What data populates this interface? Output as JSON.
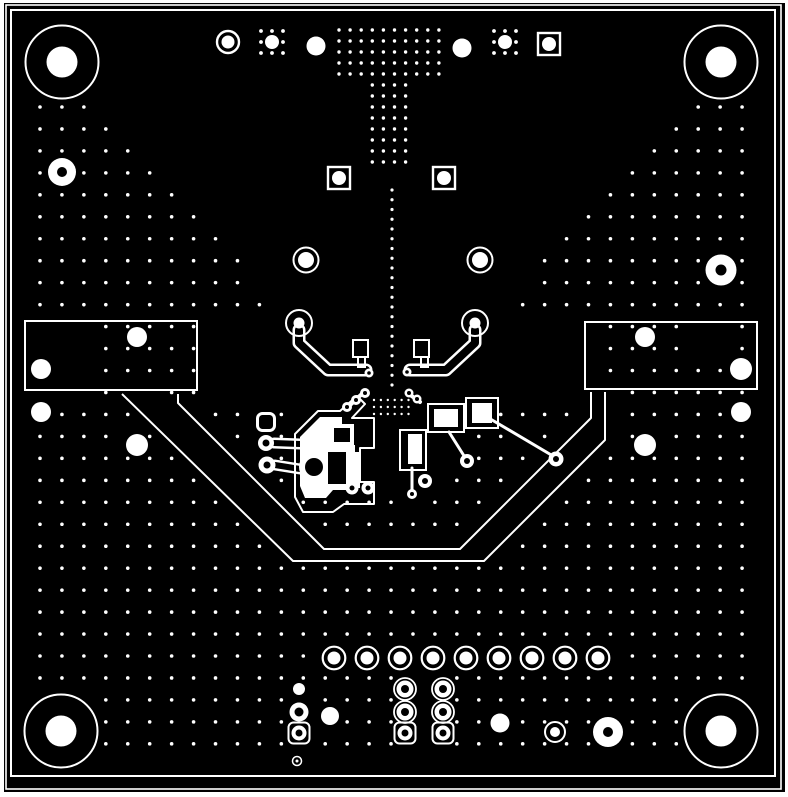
{
  "meta": {
    "title": "PCB copper layer artwork",
    "type": "pcb-gerber-view"
  },
  "canvas": {
    "w": 788,
    "h": 797
  },
  "colors": {
    "page": "#ffffff",
    "board": "#000000",
    "art": "#ffffff"
  },
  "frame": {
    "board_rect": [
      4,
      3,
      781,
      789
    ],
    "outline_rects": [
      {
        "r": [
          6,
          5,
          775,
          784
        ],
        "sw": 1.6
      },
      {
        "r": [
          11,
          10,
          764,
          766
        ],
        "sw": 2
      }
    ]
  },
  "grid": {
    "x0": 40,
    "y0": 107,
    "dx": 21.94,
    "dy": 21.96,
    "nx": 33,
    "ny": 30,
    "r": 1.8
  },
  "grid_exclusions": {
    "rects": [
      [
        0,
        0,
        788,
        97
      ],
      [
        197,
        318,
        392,
        75
      ],
      [
        0,
        318,
        102,
        75
      ],
      [
        688,
        318,
        48,
        52
      ],
      [
        285,
        393,
        165,
        104
      ],
      [
        338,
        385,
        66,
        14
      ],
      [
        464,
        396,
        36,
        34
      ],
      [
        398,
        428,
        30,
        44
      ],
      [
        426,
        402,
        40,
        32
      ]
    ],
    "polys": [
      [
        [
          95,
          97
        ],
        [
          391,
          97
        ],
        [
          391,
          318
        ],
        [
          290,
          318
        ]
      ],
      [
        [
          391,
          97
        ],
        [
          687,
          97
        ],
        [
          492,
          318
        ],
        [
          391,
          318
        ]
      ]
    ],
    "corridors": [
      {
        "pts": [
          [
            122,
            394
          ],
          [
            293,
            561
          ],
          [
            484,
            561
          ],
          [
            605,
            440
          ],
          [
            605,
            392
          ]
        ],
        "r": 6.5
      },
      {
        "pts": [
          [
            178,
            394
          ],
          [
            178,
            403
          ],
          [
            324,
            549
          ],
          [
            460,
            549
          ],
          [
            591,
            418
          ],
          [
            591,
            392
          ]
        ],
        "r": 6.5
      },
      {
        "pts": [
          [
            150,
            396
          ],
          [
            308,
            555
          ],
          [
            472,
            555
          ],
          [
            598,
            428
          ],
          [
            598,
            392
          ]
        ],
        "r": 9
      },
      {
        "pts": [
          [
            487,
            417
          ],
          [
            553,
            456
          ]
        ],
        "r": 7
      },
      {
        "pts": [
          [
            449,
            432
          ],
          [
            466,
            459
          ]
        ],
        "r": 7
      },
      {
        "pts": [
          [
            412,
            468
          ],
          [
            412,
            492
          ]
        ],
        "r": 6
      }
    ]
  },
  "t_field": {
    "wide": {
      "x0": 339,
      "dx": 11.1,
      "cols": 10,
      "y0": 30,
      "dy": 11,
      "rows": 5,
      "r": 1.7
    },
    "stem": {
      "x0": 372.3,
      "dx": 11.1,
      "cols": 4,
      "y0": 85,
      "dy": 11,
      "rows": 8,
      "r": 1.7
    }
  },
  "dotted_line": {
    "x": 392,
    "y0": 190,
    "y1": 385,
    "step": 9.75,
    "r": 1.6
  },
  "fine_grid": {
    "x0": 374,
    "dx": 6.9,
    "cols": 6,
    "y0": 400,
    "dy": 7,
    "rows": 3,
    "r": 1.2
  },
  "satellite_pads": [
    {
      "cx": 272,
      "cy": 42,
      "fill_r": 7,
      "dot_r": 1.9,
      "offset": 11
    },
    {
      "cx": 505,
      "cy": 42,
      "fill_r": 7,
      "dot_r": 1.9,
      "offset": 11
    }
  ],
  "mount_holes": {
    "pts": [
      [
        62,
        62
      ],
      [
        721,
        62
      ],
      [
        61,
        731
      ],
      [
        721,
        731
      ]
    ],
    "ring_r": 36.5,
    "ring_sw": 2,
    "fill_r": 15.5
  },
  "edge_vias": [
    [
      62,
      172,
      14,
      5
    ],
    [
      721,
      270,
      15.5,
      5.5
    ],
    [
      608,
      732,
      15,
      5
    ]
  ],
  "filled_dots": [
    [
      316,
      46,
      9.5
    ],
    [
      462,
      48,
      9.5
    ],
    [
      41,
      369,
      10
    ],
    [
      137,
      337,
      10
    ],
    [
      41,
      412,
      10
    ],
    [
      137,
      445,
      11
    ],
    [
      645,
      337,
      10
    ],
    [
      741,
      369,
      11
    ],
    [
      741,
      412,
      10
    ],
    [
      645,
      445,
      11
    ],
    [
      330,
      716,
      9
    ],
    [
      500,
      723,
      9.5
    ],
    [
      299,
      689,
      6
    ]
  ],
  "ring_pads": [
    [
      228,
      42,
      11,
      2.4,
      6.5
    ],
    [
      306,
      260,
      12.5,
      2,
      8
    ],
    [
      480,
      260,
      12.5,
      2,
      8
    ],
    [
      299,
      323,
      13,
      2,
      5.5
    ],
    [
      475,
      323,
      13,
      2,
      5.5
    ],
    [
      555,
      732,
      10,
      2,
      5
    ]
  ],
  "header_row": {
    "y": 658,
    "x0": 334,
    "dx": 33,
    "n": 9,
    "ring_r": 11.3,
    "ring_sw": 2.2,
    "fill_r": 6.5
  },
  "square_pads": {
    "size": 22,
    "sw": 2.4,
    "fill_r": 7,
    "pts": [
      [
        549,
        44
      ],
      [
        339,
        178
      ],
      [
        444,
        178
      ]
    ]
  },
  "square_annulus_pads": {
    "size": 21,
    "sw": 2,
    "ro": 7.5,
    "hole": 3.5,
    "pts": [
      [
        299,
        733
      ],
      [
        405,
        733
      ],
      [
        443,
        733
      ]
    ]
  },
  "square_outline_pads": {
    "size": 17,
    "sw": 3,
    "pts": [
      [
        266,
        422
      ]
    ]
  },
  "annulus_pads": [
    [
      299,
      712,
      9.5,
      4.5,
      0
    ],
    [
      405,
      689,
      8.5,
      4,
      11
    ],
    [
      443,
      689,
      8.5,
      4,
      11
    ],
    [
      405,
      712,
      8.5,
      4,
      11
    ],
    [
      443,
      712,
      8.5,
      4,
      11
    ],
    [
      352,
      488,
      6.5,
      2.5,
      0
    ],
    [
      368,
      488,
      6.5,
      2.5,
      0
    ],
    [
      467,
      461,
      7,
      3,
      0
    ],
    [
      425,
      481,
      7,
      3,
      0
    ],
    [
      556,
      459,
      7.5,
      3,
      0
    ],
    [
      369,
      373,
      4.5,
      1.8,
      0
    ],
    [
      407,
      372,
      4.5,
      1.8,
      0
    ],
    [
      347,
      407,
      5,
      2,
      0
    ],
    [
      356,
      400,
      5,
      2,
      0
    ],
    [
      365,
      393,
      5,
      2,
      0
    ],
    [
      409,
      393,
      4.5,
      2,
      0
    ],
    [
      417,
      399,
      4.5,
      2,
      0
    ],
    [
      412,
      494,
      5,
      2,
      0
    ],
    [
      266,
      443,
      8,
      3.5,
      0
    ],
    [
      267,
      465,
      8.5,
      3.5,
      0
    ]
  ],
  "tiny_rings": [
    [
      297,
      761,
      4.5,
      1.5
    ]
  ],
  "connector_rects": {
    "sw": 2,
    "rects": [
      [
        25,
        321,
        172,
        69
      ],
      [
        585,
        322,
        172,
        67
      ]
    ]
  },
  "band_paths": {
    "sw": 2,
    "paths": [
      "M122,394 L293,561 L484,561 L605,440 L605,392",
      "M178,394 L178,403 L324,549 L460,549 L591,418 L591,392"
    ]
  },
  "outlined_traces": [
    {
      "d": "M299,330 L299,343 L328,370 L366,370",
      "wo": 13,
      "wi": 8
    },
    {
      "d": "M475,330 L475,343 L446,370 L410,370",
      "wo": 13,
      "wi": 8
    },
    {
      "d": "M274,443 L300,444",
      "wo": 11,
      "wi": 6
    },
    {
      "d": "M275,465 L300,469",
      "wo": 11,
      "wi": 6
    }
  ],
  "footprint_outline_rects": {
    "sw": 2,
    "rects": [
      [
        353,
        340,
        15,
        17
      ],
      [
        358,
        357,
        7,
        10
      ],
      [
        414,
        340,
        15,
        17
      ],
      [
        421,
        357,
        7,
        10
      ],
      [
        428,
        404,
        36,
        28
      ],
      [
        466,
        398,
        32,
        30
      ],
      [
        400,
        430,
        26,
        40
      ]
    ]
  },
  "cluster": {
    "fill_circles": [
      [
        314,
        467,
        15
      ]
    ],
    "fill_polys": [
      "M300,437 L320,417 L342,417 L342,445 L355,445 L355,459 L300,459 Z",
      "M300,459 L355,459 L355,490 L333,490 L326,498 L305,498 L300,486 Z"
    ],
    "fill_rects": [
      [
        330,
        424,
        24,
        22
      ],
      [
        348,
        452,
        12,
        36
      ],
      [
        434,
        409,
        24,
        18
      ],
      [
        472,
        403,
        20,
        20
      ],
      [
        408,
        434,
        14,
        30
      ]
    ],
    "black_insets": {
      "rects": [
        [
          334,
          428,
          16,
          14
        ],
        [
          328,
          452,
          18,
          32
        ]
      ],
      "circles": [
        [
          314,
          467,
          9
        ]
      ]
    },
    "outline_paths": {
      "sw": 2,
      "paths": [
        "M295,445 L295,434 L318,411 L340,411 L357,396 L365,404 L352,418 L374,418 L374,448 L360,448 L360,482 L374,482 L374,504 L344,504 L333,512 L303,512 L295,497 Z"
      ]
    },
    "trace_strokes": [
      {
        "d": "M349,406 L364,392",
        "w": 4
      },
      {
        "d": "M409,394 L420,402",
        "w": 4
      },
      {
        "d": "M449,432 L466,459",
        "w": 3
      },
      {
        "d": "M487,417 L553,456",
        "w": 3
      },
      {
        "d": "M412,468 L412,492",
        "w": 3
      }
    ]
  }
}
